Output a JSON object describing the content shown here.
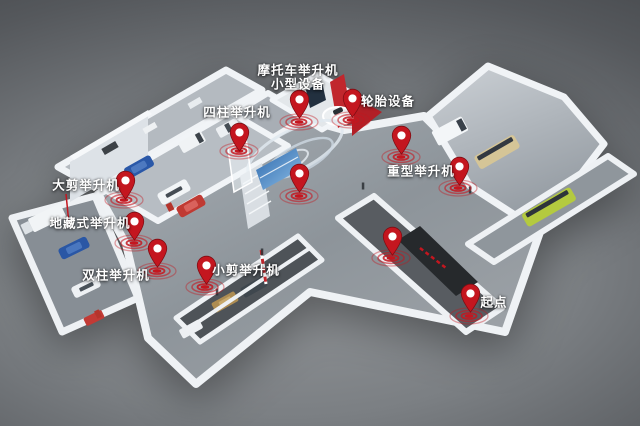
{
  "map": {
    "type": "3d-isometric-facility-map",
    "marker_count": 12,
    "labeled_zones": [
      "摩托车举升机",
      "小型设备",
      "四柱举升机",
      "轮胎设备",
      "大剪举升机",
      "重型举升机",
      "地藏式举升机",
      "双柱举升机",
      "小剪举升机",
      "起点"
    ]
  },
  "colors": {
    "pin_fill": "#c4161f",
    "pin_stroke": "#7e0d13",
    "pin_hole": "#ffffff",
    "ripple": "#c4161f",
    "label_text": "#ffffff",
    "accent_wall_red": "#c1272d",
    "background_light": "#96999c",
    "background_dark": "#3b3e42"
  },
  "markers": [
    {
      "name": "motorcycle-lift-small-equipment",
      "label": "摩托车举升机\n小型设备",
      "label_x": 298,
      "label_y": 78,
      "pin": {
        "x": 299,
        "y": 119
      },
      "ripple": {
        "x": 299,
        "y": 122
      }
    },
    {
      "name": "four-post-lift",
      "label": "四柱举升机",
      "label_x": 237,
      "label_y": 113,
      "pin": {
        "x": 239,
        "y": 152
      },
      "ripple": {
        "x": 239,
        "y": 151
      }
    },
    {
      "name": "tire-equipment",
      "label": "轮胎设备",
      "label_x": 388,
      "label_y": 102,
      "pin": {
        "x": 352,
        "y": 118
      },
      "ripple": {
        "x": 351,
        "y": 120
      }
    },
    {
      "name": "large-scissor-lift",
      "label": "大剪举升机",
      "label_x": 86,
      "label_y": 186,
      "pin": {
        "x": 125,
        "y": 200
      },
      "ripple": {
        "x": 124,
        "y": 200
      }
    },
    {
      "name": "center-exhibit",
      "label": "",
      "pin": {
        "x": 299,
        "y": 193
      },
      "ripple": {
        "x": 299,
        "y": 196
      }
    },
    {
      "name": "heavy-duty-lift",
      "label": "重型举升机",
      "label_x": 421,
      "label_y": 172,
      "pin": {
        "x": 401,
        "y": 155
      },
      "ripple": {
        "x": 401,
        "y": 157
      }
    },
    {
      "name": "heavy-duty-lift-2",
      "label": "",
      "pin": {
        "x": 459,
        "y": 186
      },
      "ripple": {
        "x": 458,
        "y": 188
      }
    },
    {
      "name": "in-ground-lift",
      "label": "地藏式举升机",
      "label_x": 90,
      "label_y": 224,
      "pin": {
        "x": 134,
        "y": 241
      },
      "ripple": {
        "x": 134,
        "y": 243
      }
    },
    {
      "name": "two-post-lift",
      "label": "双柱举升机",
      "label_x": 116,
      "label_y": 276,
      "pin": {
        "x": 157,
        "y": 268
      },
      "ripple": {
        "x": 157,
        "y": 271
      }
    },
    {
      "name": "small-scissor-lift",
      "label": "小剪举升机",
      "label_x": 246,
      "label_y": 271,
      "pin": {
        "x": 206,
        "y": 285
      },
      "ripple": {
        "x": 205,
        "y": 287
      }
    },
    {
      "name": "corridor-exhibit",
      "label": "",
      "pin": {
        "x": 392,
        "y": 256
      },
      "ripple": {
        "x": 391,
        "y": 258
      }
    },
    {
      "name": "start-point",
      "label": "起点",
      "label_x": 494,
      "label_y": 303,
      "pin": {
        "x": 470,
        "y": 313
      },
      "ripple": {
        "x": 469,
        "y": 316
      }
    }
  ]
}
